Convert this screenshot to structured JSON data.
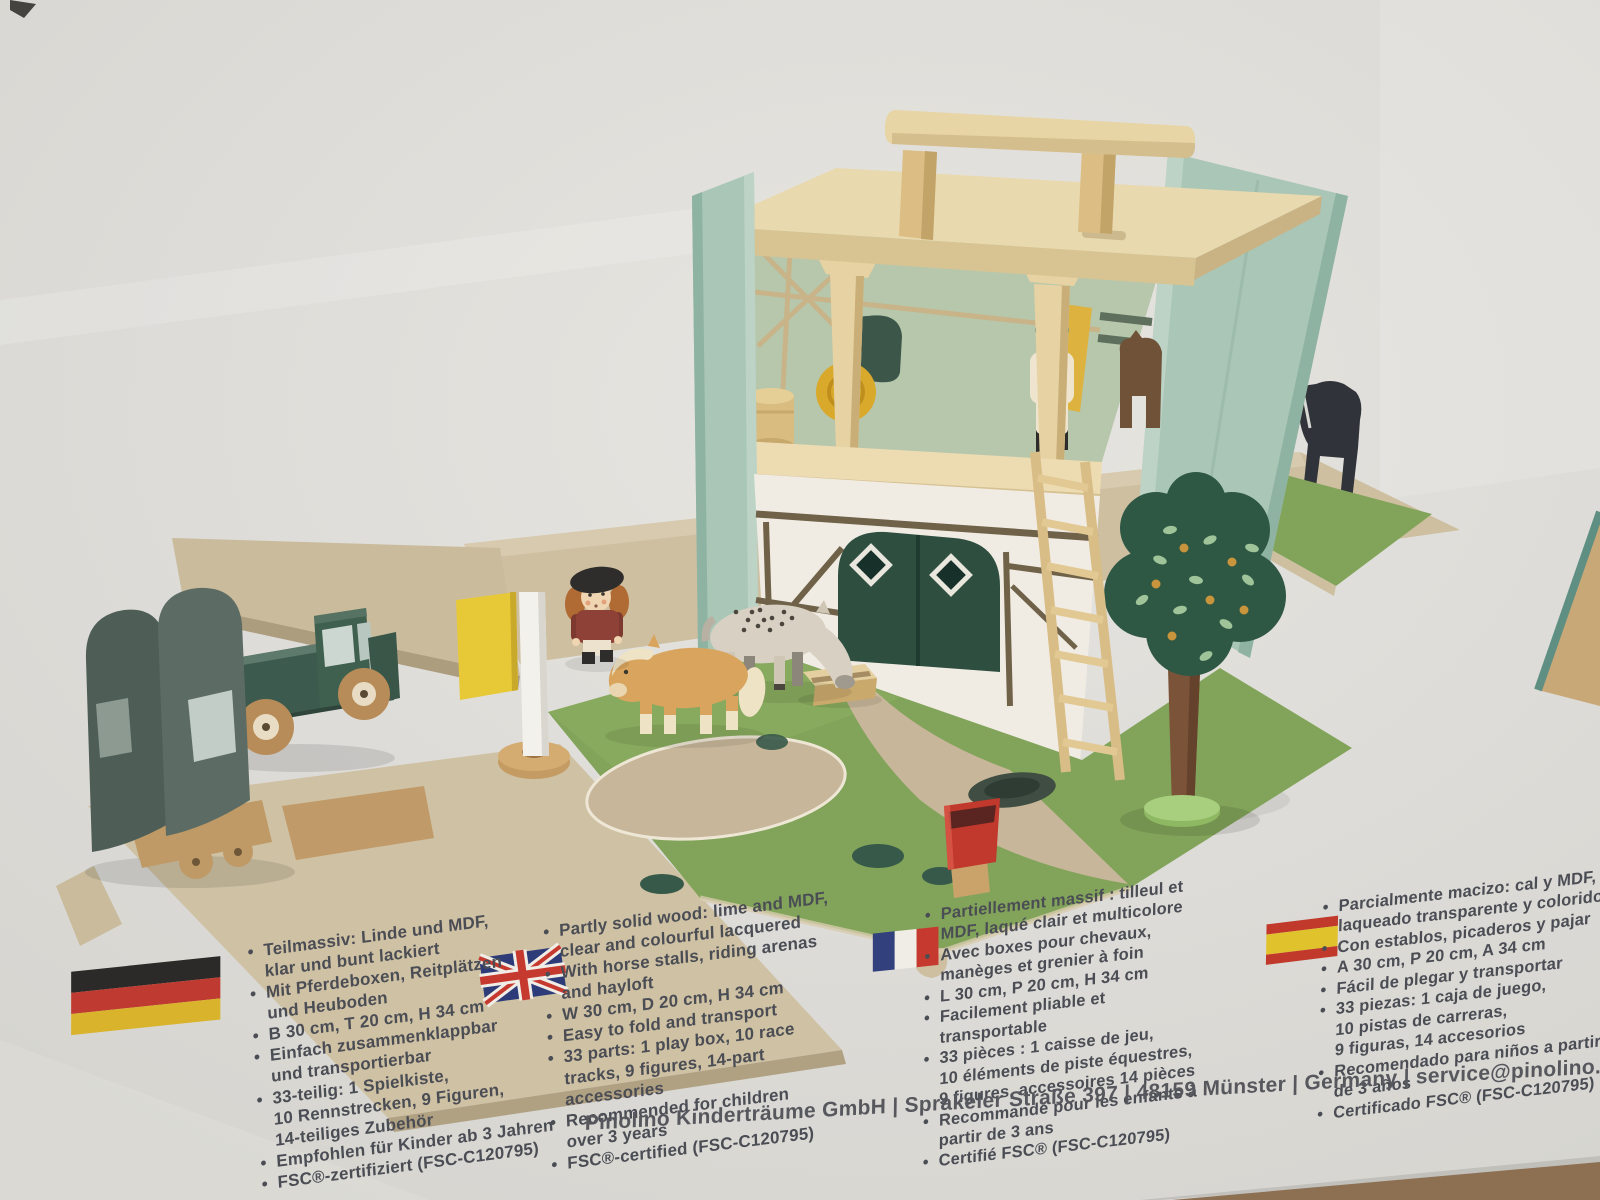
{
  "palette": {
    "mint_panel": "#a9c6b6",
    "roof_wood": "#e9d9af",
    "track_wood": "#cdbfa0",
    "grass_green": "#82a45a",
    "barn_door_green": "#2e4f40",
    "accent_yellow": "#e7c937",
    "truck_green": "#3d5a4e",
    "text_gray": "#4b4d55"
  },
  "info_columns": [
    {
      "lang": "de",
      "flag": "flag-germany",
      "bullets": [
        "Teilmassiv: Linde und MDF,\nklar und bunt lackiert",
        "Mit Pferdeboxen, Reitplätzen\nund Heuboden",
        "B 30 cm, T 20 cm, H 34 cm",
        "Einfach zusammenklappbar\nund transportierbar",
        "33-teilig: 1 Spielkiste,\n10 Rennstrecken, 9 Figuren,\n14-teiliges Zubehör",
        "Empfohlen für Kinder ab 3 Jahren",
        "FSC®-zertifiziert (FSC-C120795)"
      ]
    },
    {
      "lang": "en",
      "flag": "flag-united-kingdom",
      "bullets": [
        "Partly solid wood: lime and MDF,\nclear and colourful lacquered",
        "With horse stalls, riding arenas\nand hayloft",
        "W 30 cm, D 20 cm, H 34 cm",
        "Easy to fold and transport",
        "33 parts: 1 play box, 10 race\ntracks, 9 figures, 14-part\naccessories",
        "Recommended for children\nover 3 years",
        "FSC®-certified (FSC-C120795)"
      ]
    },
    {
      "lang": "fr",
      "flag": "flag-france",
      "bullets": [
        "Partiellement massif : tilleul et\nMDF, laqué clair et multicolore",
        "Avec boxes pour chevaux,\nmanèges et grenier à foin",
        "L 30 cm, P 20 cm, H 34 cm",
        "Facilement pliable et\ntransportable",
        "33 pièces : 1 caisse de jeu,\n10 éléments de piste équestres,\n9 figures, accessoires 14 pièces",
        "Recommandé pour les enfants à\npartir de 3 ans",
        "Certifié FSC® (FSC-C120795)"
      ]
    },
    {
      "lang": "es",
      "flag": "flag-spain",
      "bullets": [
        "Parcialmente macizo: cal y MDF,\nlaqueado transparente y colorido",
        "Con establos, picaderos y pajar",
        "A 30 cm, P 20 cm, A 34 cm",
        "Fácil de plegar y transportar",
        "33 piezas: 1 caja de juego,\n10 pistas de carreras,\n9 figuras, 14 accesorios",
        "Recomendado para niños a partir\nde 3 años",
        "Certificado FSC® (FSC-C120795)"
      ]
    }
  ],
  "footer": {
    "text": "Pinolino Kinderträume GmbH | Sprakeler Straße 397 | 48159 Münster | Germany | service@pinolino."
  }
}
